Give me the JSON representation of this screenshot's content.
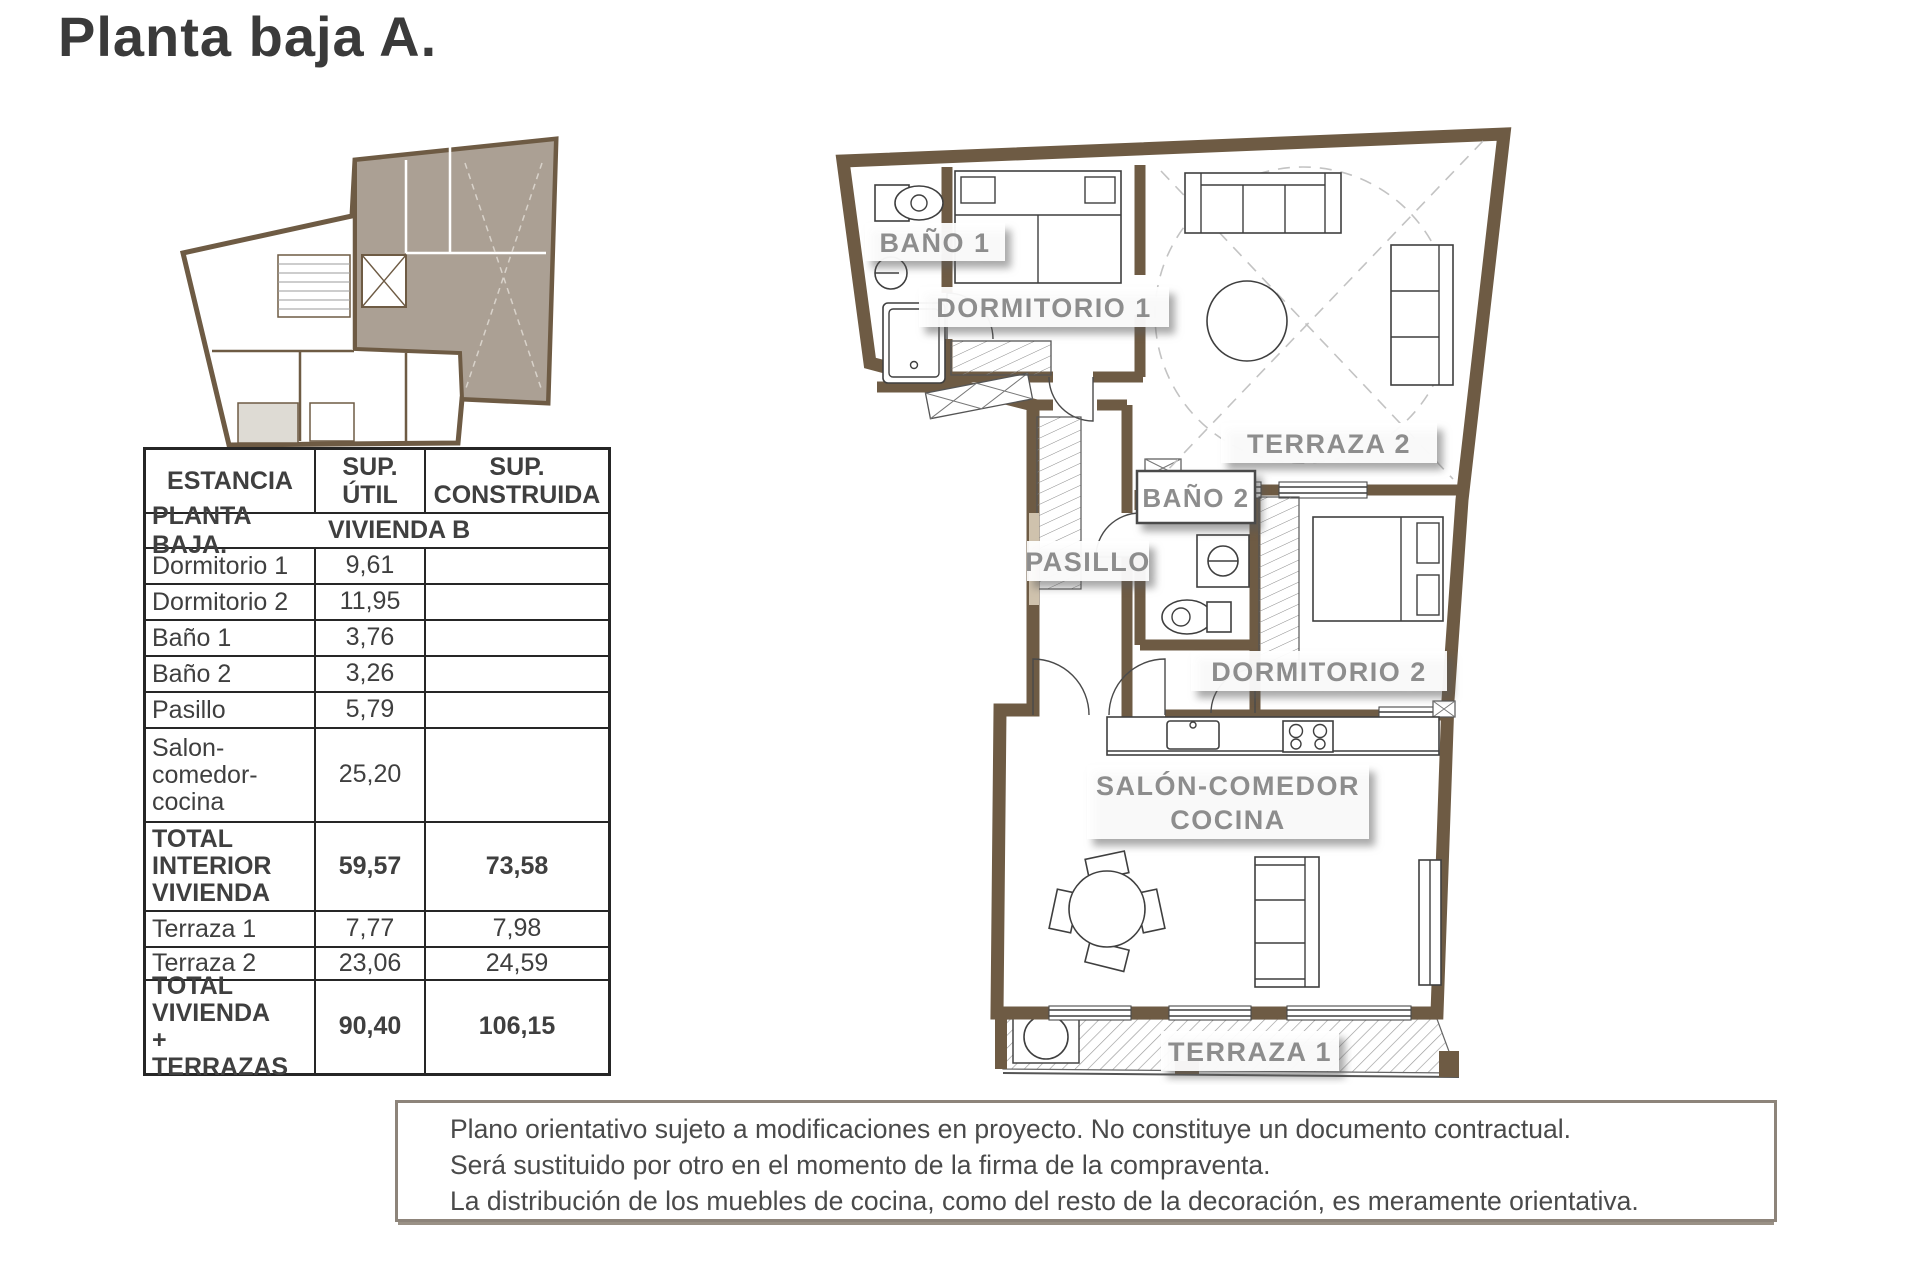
{
  "title": "Planta baja A.",
  "colors": {
    "wall_brown": "#6e5b44",
    "keyplan_highlight": "#aba094",
    "room_label_gray": "#8d8d8d",
    "table_text": "#3f3f3f",
    "disclaimer_border": "#8d847a"
  },
  "table": {
    "headers": [
      "ESTANCIA",
      "SUP. ÚTIL",
      "SUP. CONSTRUIDA"
    ],
    "section": {
      "title": "PLANTA BAJA.",
      "subtitle": "VIVIENDA B"
    },
    "rows": [
      {
        "label": "Dormitorio 1",
        "util": "9,61",
        "construida": ""
      },
      {
        "label": "Dormitorio 2",
        "util": "11,95",
        "construida": ""
      },
      {
        "label": "Baño 1",
        "util": "3,76",
        "construida": ""
      },
      {
        "label": "Baño 2",
        "util": "3,26",
        "construida": ""
      },
      {
        "label": "Pasillo",
        "util": "5,79",
        "construida": ""
      },
      {
        "label": "Salon-comedor-cocina",
        "util": "25,20",
        "construida": ""
      },
      {
        "label": "TOTAL INTERIOR VIVIENDA",
        "util": "59,57",
        "construida": "73,58"
      },
      {
        "label": "Terraza 1",
        "util": "7,77",
        "construida": "7,98"
      },
      {
        "label": "Terraza 2",
        "util": "23,06",
        "construida": "24,59"
      },
      {
        "label": "TOTAL VIVIENDA + TERRAZAS",
        "util": "90,40",
        "construida": "106,15"
      }
    ]
  },
  "plan": {
    "labels": {
      "bano1": "BAÑO 1",
      "dormitorio1": "DORMITORIO 1",
      "terraza2": "TERRAZA 2",
      "pasillo": "PASILLO",
      "bano2": "BAÑO 2",
      "dormitorio2": "DORMITORIO 2",
      "salon_line1": "SALÓN-COMEDOR",
      "salon_line2": "COCINA",
      "terraza1": "TERRAZA 1"
    }
  },
  "disclaimer": {
    "lines": [
      "Plano orientativo sujeto a modificaciones en proyecto. No constituye un documento contractual.",
      "Será sustituido por otro en el momento de la firma de la compraventa.",
      "La distribución de los muebles de cocina, como del resto de la decoración, es meramente orientativa."
    ]
  }
}
